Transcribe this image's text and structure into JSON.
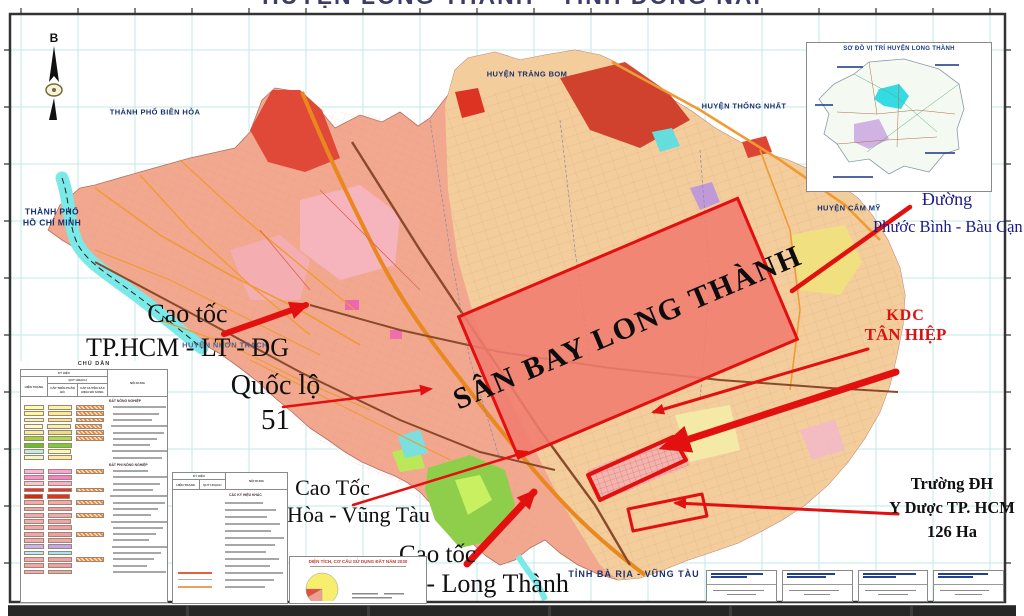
{
  "title": "HUYỆN LONG THÀNH - TỈNH ĐỒNG NAI",
  "colors": {
    "accent-red": "#e31010",
    "kdc-red": "#dd1111",
    "navy": "#18306e",
    "map-salmon": "#f2a88f",
    "map-tan": "#f3cf9e",
    "grid-cyan": "#c2eaea",
    "water-cyan": "#7ce9e9",
    "road-orange": "#ef9b33"
  },
  "compass": {
    "north_label": "B"
  },
  "inset": {
    "title": "SƠ ĐỒ VỊ TRÍ HUYỆN LONG THÀNH"
  },
  "region_labels": {
    "bien_hoa": "THÀNH PHỐ BIÊN HÒA",
    "trang_bom": "HUYỆN TRẢNG BOM",
    "thong_nhat": "HUYỆN THỐNG NHẤT",
    "tp_hcm": "THÀNH PHỐ\nHỒ CHÍ MINH",
    "cam_my": "HUYỆN CẨM MỸ",
    "nhon_trach": "HUYỆN NHƠN TRẠCH",
    "ba_ria": "TỈNH BÀ RỊA - VŨNG TÀU"
  },
  "annotations": {
    "airport": "SÂN BAY LONG THÀNH",
    "cao_toc_hcm": {
      "line1": "Cao tốc",
      "line2": "TP.HCM - LT - DG"
    },
    "quoc_lo_51": {
      "line1": "Quốc lộ",
      "line2": "51"
    },
    "cao_toc_bh_vt": {
      "line1": "Cao Tốc",
      "line2": "Biên Hòa - Vũng Tàu"
    },
    "cao_toc_bl_lt": {
      "line1": "Cao tốc",
      "line2": "Bến Lức - Long Thành"
    },
    "duong_pb_bc": {
      "line1": "Đường",
      "line2": "Phước Bình - Bàu Cạn"
    },
    "kdc_tan_hiep": {
      "line1": "KDC",
      "line2": "TÂN HIỆP"
    },
    "truong_dh": {
      "line1": "Trường ĐH",
      "line2": "Y Dược TP. HCM",
      "line3": "126 Ha"
    }
  },
  "legend1": {
    "title": "CHÚ DẪN",
    "col_ky_hieu": "KÝ HIỆU",
    "col_noi_dung": "NỘI DUNG",
    "col_hien_trang": "HIỆN TRẠNG",
    "col_quy_hoach": "QUY HOẠCH",
    "col_cap_tren": "CẤP TRÊN PHÂN BỔ",
    "col_cap_huyen": "CẤP HUYỆN XÁC ĐỊNH BỔ SUNG",
    "rows": [
      {
        "h": "ĐẤT NÔNG NGHIỆP"
      },
      {
        "c1": "#ffffa6",
        "c2": "#fff2a0",
        "c3": "hatch"
      },
      {
        "c1": "#fff89a",
        "c2": "#ffe98a",
        "c3": "hatch"
      },
      {
        "c1": "#f7f2a8",
        "c2": "#f4e48e",
        "c3": "hatch"
      },
      {
        "c1": "#fdfacb",
        "c2": "#f9efad",
        "c3": "hatch"
      },
      {
        "c1": "#f3ef9a",
        "c2": "#eedd7f",
        "c3": "hatch"
      },
      {
        "c1": "#9ed437",
        "c2": "#aade44",
        "c3": "hatch"
      },
      {
        "c1": "#63c61e",
        "c2": "#74d32b",
        "c3": ""
      },
      {
        "c1": "#bdeee0",
        "c2": "#fef9a6",
        "c3": ""
      },
      {
        "c1": "#eef9c8",
        "c2": "#ffec9d",
        "c3": ""
      },
      {
        "h": "ĐẤT PHI NÔNG NGHIỆP"
      },
      {
        "c1": "#ffb3de",
        "c2": "#ff9fd6",
        "c3": "hatch"
      },
      {
        "c1": "#ff8fd0",
        "c2": "#ff7cc8",
        "c3": ""
      },
      {
        "c1": "#ffc3cf",
        "c2": "#ffafc2",
        "c3": ""
      },
      {
        "c1": "#f53022",
        "c2": "#f53022",
        "c3": "hatch"
      },
      {
        "c1": "#d42a10",
        "c2": "#e03418",
        "c3": ""
      },
      {
        "c1": "#f6a8a4",
        "c2": "#f6a8a4",
        "c3": "hatch"
      },
      {
        "c1": "#f5a3a3",
        "c2": "#f19a9e",
        "c3": ""
      },
      {
        "c1": "#f3a6ab",
        "c2": "#f3a6ab",
        "c3": "hatch"
      },
      {
        "c1": "#f6adad",
        "c2": "#f2a2a6",
        "c3": ""
      },
      {
        "c1": "#f5a8a8",
        "c2": "#f0a0a4",
        "c3": ""
      },
      {
        "c1": "#f4a4a8",
        "c2": "#efa09e",
        "c3": "hatch"
      },
      {
        "c1": "#f6abab",
        "c2": "#f2a6a6",
        "c3": ""
      },
      {
        "c1": "#c9b6f0",
        "c2": "#bfa9ee",
        "c3": ""
      },
      {
        "c1": "#aff0f0",
        "c2": "#9fe9ec",
        "c3": ""
      },
      {
        "c1": "#f5a9a9",
        "c2": "#f0a2a2",
        "c3": "hatch"
      },
      {
        "c1": "#f4a6a6",
        "c2": "#efa0a0",
        "c3": ""
      },
      {
        "c1": "#f5abab",
        "c2": "#f0a5a5",
        "c3": ""
      }
    ]
  },
  "legend2": {
    "col_ky_hieu": "KÝ HIỆU",
    "col_hien_trang": "HIỆN TRẠNG",
    "col_quy_hoach": "QUY HOẠCH",
    "col_noi_dung": "NỘI DUNG",
    "section": "CÁC KÝ HIỆU KHÁC",
    "row_count": 13
  },
  "pie": {
    "title": "DIỆN TÍCH, CƠ CẤU SỬ DỤNG ĐẤT NĂM 2030"
  }
}
